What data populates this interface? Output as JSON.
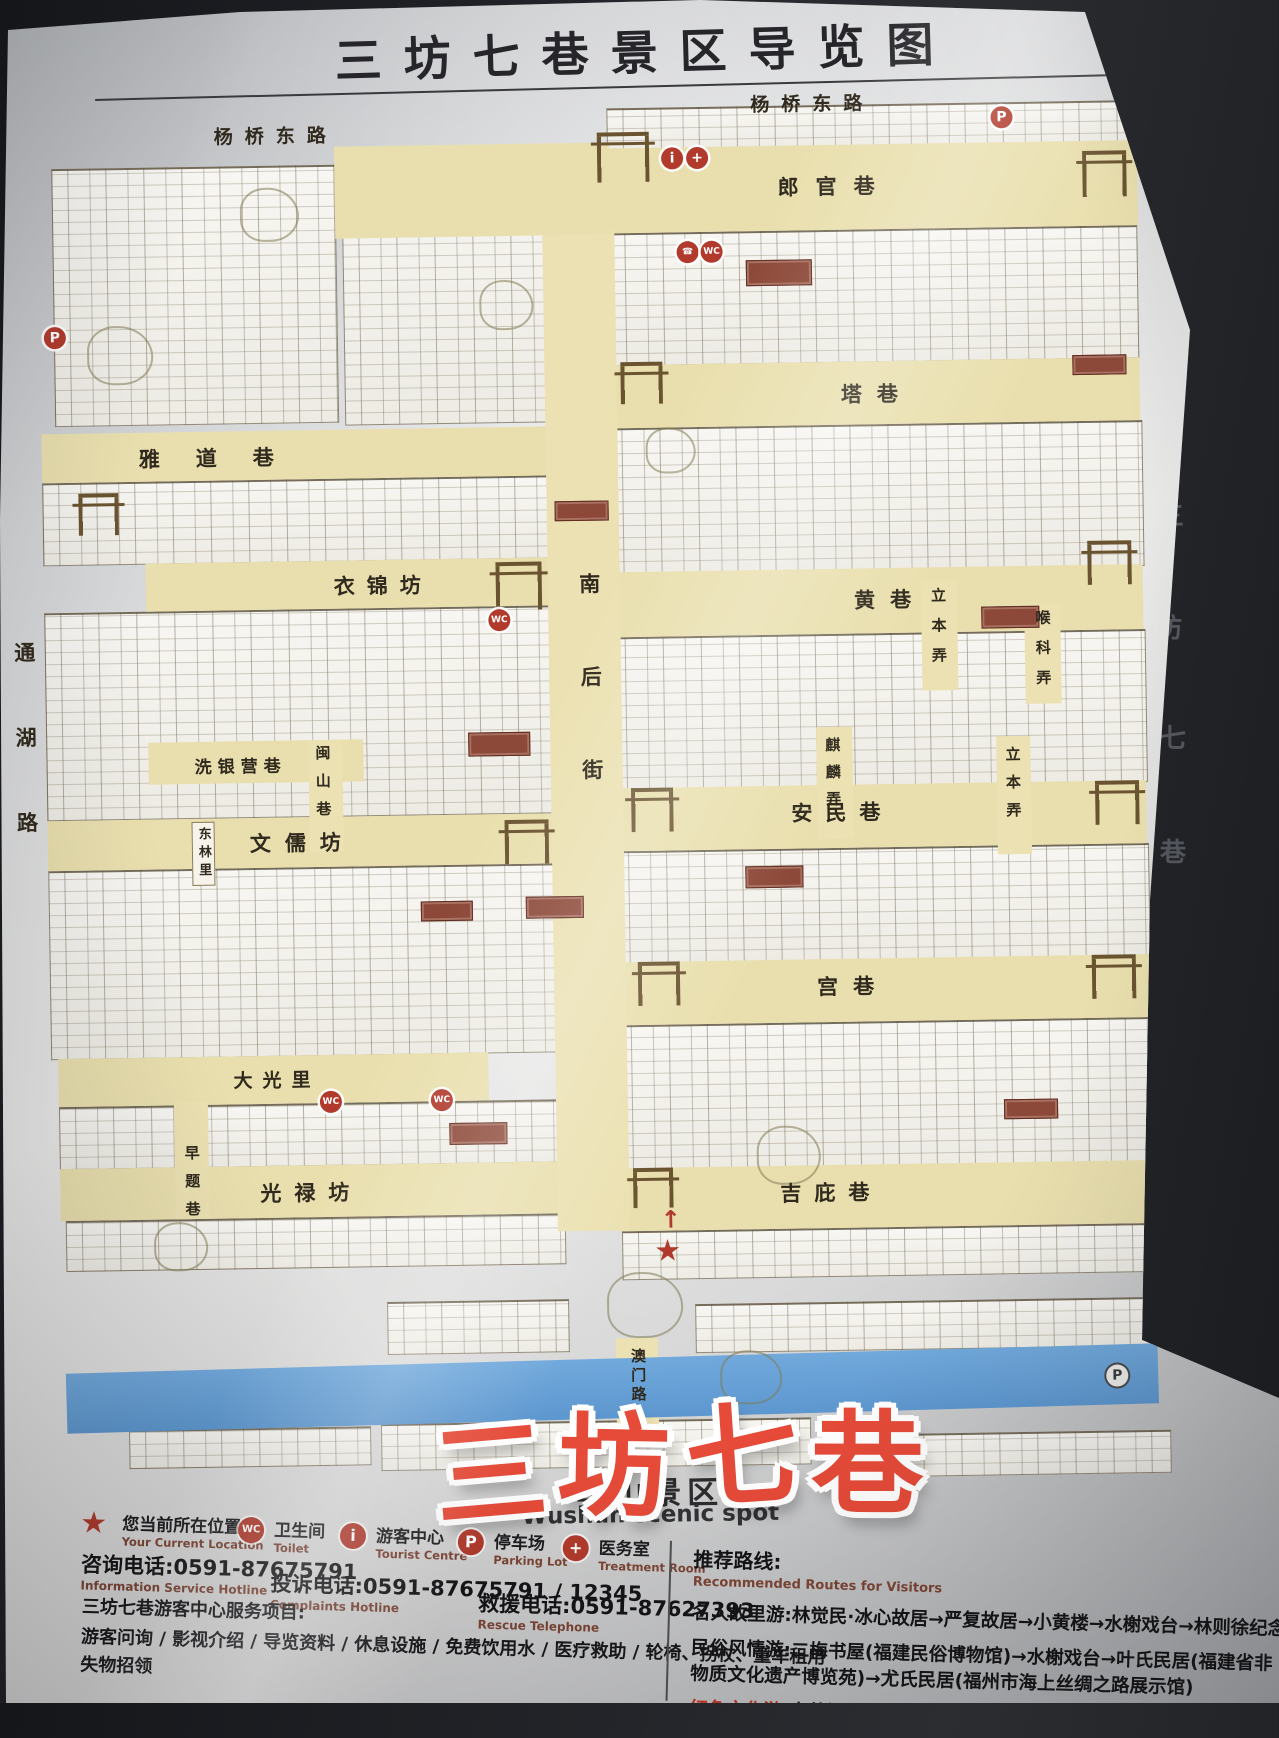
{
  "title": "三坊七巷景区导览图",
  "watermark": {
    "chars": [
      "三",
      "坊",
      "七",
      "巷"
    ]
  },
  "edge_reflection": {
    "chars": [
      "三",
      "坊",
      "七",
      "巷"
    ]
  },
  "map": {
    "roads": {
      "yangqiao_left": "杨桥东路",
      "yangqiao_right": "杨桥东路",
      "langguanxiang": "郎官巷",
      "taxiang": "塔巷",
      "huangxiang": "黄巷",
      "anminxiang": "安民巷",
      "gongxiang": "宫巷",
      "jipixiang": "吉庇巷",
      "yadaoxiang": "雅道巷",
      "yijinfang": "衣锦坊",
      "wenrufang": "文儒坊",
      "daguangli": "大光里",
      "guanglufang": "光禄坊",
      "xiyinyingxiang": "洗银营巷",
      "minshanxiang": "闽山巷",
      "donglinli": "东林里",
      "zaotixiang": "早题巷",
      "libennong_north": "立本弄",
      "houkenong": "喉科弄",
      "qilinnong": "麒麟弄",
      "libennong_south": "立本弄",
      "nanhoujie": "南后街",
      "tonghulu": "通湖路",
      "aomenlu": "澳门路"
    },
    "icons": {
      "parking": "P",
      "info": "i",
      "medical": "+",
      "toilet": "WC",
      "phone": "☎",
      "star": "★",
      "arrow": "↑"
    }
  },
  "wushan": {
    "cn": "乌山景区",
    "en": "Wushan scenic spot"
  },
  "legend": {
    "items": [
      {
        "icon": "star-icon",
        "cn": "您当前所在位置",
        "en": "Your Current Location"
      },
      {
        "icon": "toilet-icon",
        "cn": "卫生间",
        "en": "Toilet"
      },
      {
        "icon": "info-icon",
        "cn": "游客中心",
        "en": "Tourist Centre"
      },
      {
        "icon": "parking-icon",
        "cn": "停车场",
        "en": "Parking Lot"
      },
      {
        "icon": "medical-icon",
        "cn": "医务室",
        "en": "Treatment Room"
      }
    ]
  },
  "hotlines": [
    {
      "cn": "咨询电话:0591-87675791",
      "en": "Information Service Hotline"
    },
    {
      "cn": "投诉电话:0591-87675791 / 12345",
      "en": "Complaints Hotline"
    },
    {
      "cn": "救援电话:0591-87627393",
      "en": "Rescue Telephone"
    }
  ],
  "services": {
    "title": "三坊七巷游客中心服务项目:",
    "line1": "游客问询 / 影视介绍 / 导览资料 / 休息设施 / 免费饮用水 / 医疗救助 / 轮椅、拐杖、童车租用",
    "line2": "失物招领"
  },
  "routes": {
    "title": "推荐路线:",
    "subtitle": "Recommended Routes for Visitors",
    "items": [
      {
        "lead": "名人故里游:",
        "text": "林觉民·冰心故居→严复故居→小黄楼→水榭戏台→林则徐纪念馆",
        "lead_color": "black"
      },
      {
        "lead": "民俗风情游:",
        "text": "二梅书屋(福建民俗博物馆)→水榭戏台→叶氏民居(福建省非物质文化遗产博览苑)→尤氏民居(福州市海上丝绸之路展示馆)",
        "lead_color": "black"
      },
      {
        "lead": "红色文化游:",
        "text": "中共福州市委旧址→勤廉馆→三坊七巷保护成果展",
        "lead_color": "red"
      }
    ]
  },
  "colors": {
    "accent_red": "#b13a2c",
    "river_blue": "#5d97cf",
    "street_cream": "#e9dfae",
    "watermark_red": "#e64a38"
  }
}
